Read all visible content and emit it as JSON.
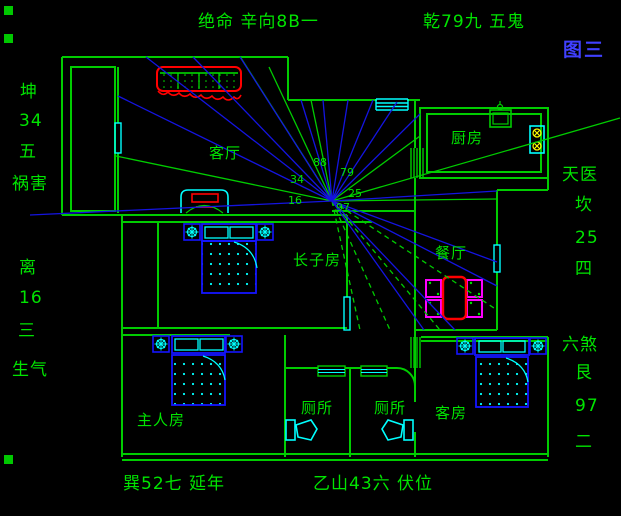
{
  "figure_label": "图三",
  "colors": {
    "wall": "#00cc00",
    "text": "#00e400",
    "ray_blue": "#1414e0",
    "cyan": "#00ffff",
    "furniture_blue": "#1414ff",
    "red": "#ff0000",
    "magenta": "#ff00ff",
    "yellow": "#ffff00",
    "figure_blue": "#4040ff"
  },
  "perimeter": {
    "top_left": "绝命 辛向8B一",
    "top_right": "乾79九 五鬼",
    "left": [
      "坤",
      "34",
      "五",
      "祸害",
      "离",
      "16",
      "三",
      "生气"
    ],
    "right": [
      "天医",
      "坎",
      "25",
      "四",
      "六煞",
      "艮",
      "97",
      "二"
    ],
    "bottom_left": "巽52七 延年",
    "bottom_center": "乙山43六 伏位"
  },
  "rooms": {
    "living": "客厅",
    "kitchen": "厨房",
    "eldest_son": "长子房",
    "dining": "餐厅",
    "master": "主人房",
    "toilet_left": "厕所",
    "toilet_right": "厕所",
    "guest": "客房"
  },
  "compass": {
    "center": {
      "x": 332,
      "y": 201
    },
    "numbers": [
      {
        "t": "88",
        "x": 313,
        "y": 157
      },
      {
        "t": "79",
        "x": 340,
        "y": 167
      },
      {
        "t": "34",
        "x": 290,
        "y": 174
      },
      {
        "t": "25",
        "x": 348,
        "y": 188
      },
      {
        "t": "16",
        "x": 288,
        "y": 195
      },
      {
        "t": "97",
        "x": 336,
        "y": 202
      }
    ],
    "blue_rays": [
      [
        30,
        215
      ],
      [
        118,
        96
      ],
      [
        146,
        57
      ],
      [
        193,
        57
      ],
      [
        240,
        57
      ],
      [
        301,
        100
      ],
      [
        323,
        100
      ],
      [
        348,
        100
      ],
      [
        373,
        100
      ],
      [
        397,
        102
      ],
      [
        420,
        114
      ],
      [
        497,
        191
      ],
      [
        497,
        262
      ],
      [
        497,
        286
      ],
      [
        455,
        330
      ],
      [
        424,
        330
      ]
    ],
    "green_rays": [
      [
        116,
        156
      ],
      [
        241,
        58
      ],
      [
        269,
        67
      ],
      [
        311,
        100
      ],
      [
        420,
        136
      ],
      [
        620,
        118
      ],
      [
        497,
        199
      ]
    ],
    "green_dashed_rays": [
      [
        360,
        330
      ],
      [
        390,
        330
      ],
      [
        440,
        330
      ],
      [
        497,
        310
      ]
    ]
  }
}
